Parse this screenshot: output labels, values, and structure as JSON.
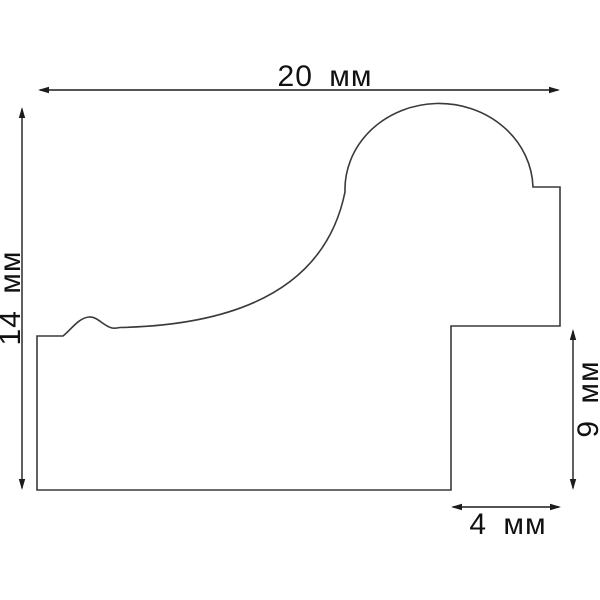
{
  "drawing": {
    "kind": "moulding-profile-cross-section"
  },
  "colors": {
    "background": "#ffffff",
    "outline": "#3a3a3a",
    "dimension": "#1c1c1c",
    "text": "#111111"
  },
  "dimensions": {
    "width": {
      "label": "20 мм",
      "value": 20,
      "unit": "мм"
    },
    "height": {
      "label": "14 мм",
      "value": 14,
      "unit": "мм"
    },
    "right_height": {
      "label": "9 мм",
      "value": 9,
      "unit": "мм"
    },
    "bottom_width": {
      "label": "4 мм",
      "value": 4,
      "unit": "мм"
    }
  }
}
